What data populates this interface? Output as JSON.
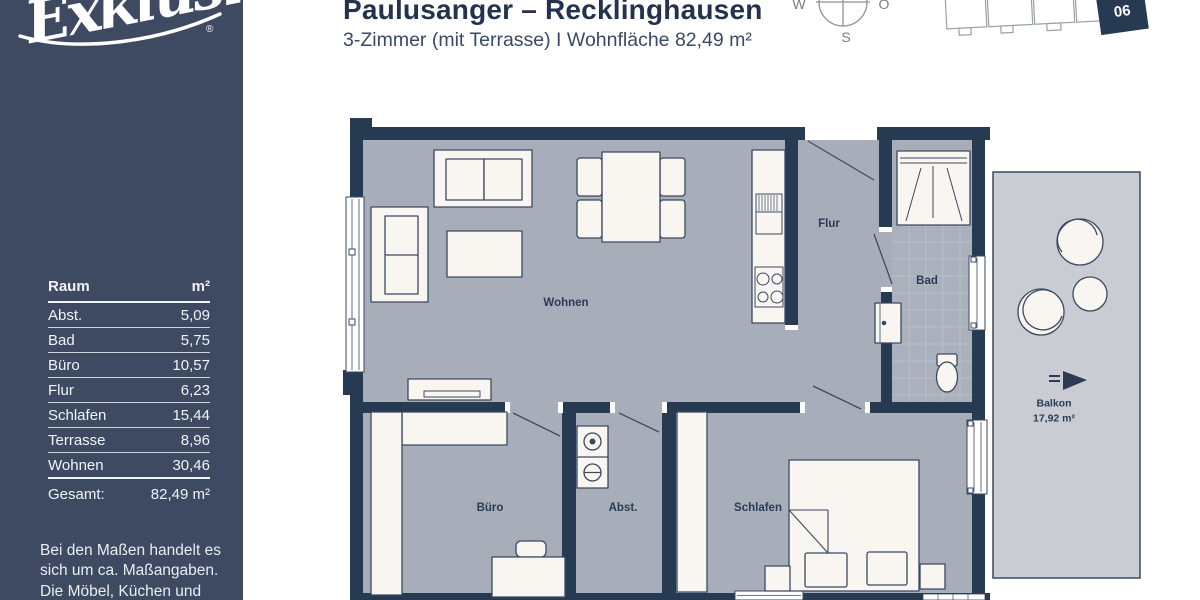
{
  "logo": {
    "name": "Exklusiv",
    "registered": "®"
  },
  "header": {
    "title": "Paulusanger – Recklinghausen",
    "subtitle": "3-Zimmer (mit Terrasse) I Wohnfläche 82,49 m²"
  },
  "compass": {
    "west": "W",
    "east": "O",
    "south": "S"
  },
  "site_plan": {
    "unit": "06"
  },
  "room_table": {
    "col_room": "Raum",
    "col_area": "m²",
    "rows": [
      {
        "room": "Abst.",
        "area": "5,09"
      },
      {
        "room": "Bad",
        "area": "5,75"
      },
      {
        "room": "Büro",
        "area": "10,57"
      },
      {
        "room": "Flur",
        "area": "6,23"
      },
      {
        "room": "Schlafen",
        "area": "15,44"
      },
      {
        "room": "Terrasse",
        "area": "8,96"
      },
      {
        "room": "Wohnen",
        "area": "30,46"
      }
    ],
    "total_label": "Gesamt:",
    "total_area": "82,49 m²"
  },
  "disclaimer": "Bei den Maßen handelt es sich um ca. Maßangaben. Die Möbel, Küchen und Sanitärobjekte sind",
  "plan_labels": {
    "wohnen": "Wohnen",
    "flur": "Flur",
    "bad": "Bad",
    "buero": "Büro",
    "abst": "Abst.",
    "schlafen": "Schlafen",
    "balkon": "Balkon",
    "balkon_area": "17,92 m²"
  },
  "colors": {
    "sidebar": "#3e4a62",
    "wall": "#263a52",
    "floor": "#a8aeb9",
    "balcony_floor": "#c9cdd3",
    "furniture": "#f9f6f1",
    "accent_text": "#23334e"
  }
}
